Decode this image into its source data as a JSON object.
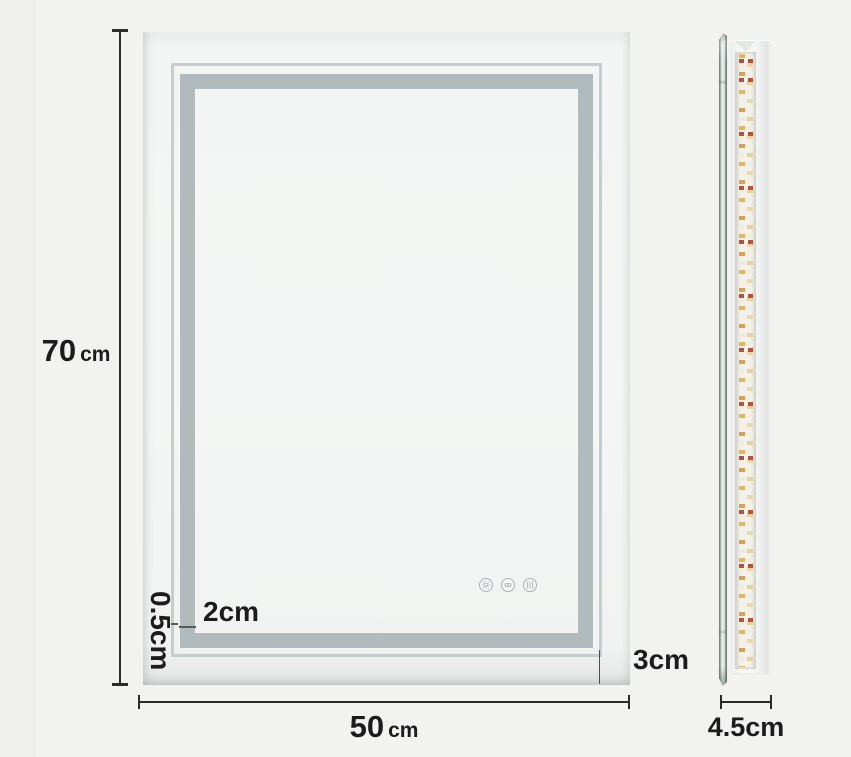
{
  "title": "LED bathroom mirror dimension diagram",
  "front_view": {
    "touch_panel": {
      "buttons": [
        {
          "icon": "brightness-icon"
        },
        {
          "icon": "color-temp-icon"
        },
        {
          "icon": "defog-icon"
        }
      ]
    }
  },
  "side_view": {
    "parts": [
      "mirror-glass-edge",
      "led-strip",
      "back-panel"
    ]
  },
  "dimensions": {
    "height": {
      "value": "70",
      "unit": "cm"
    },
    "width": {
      "value": "50",
      "unit": "cm"
    },
    "depth": {
      "label": "4.5cm"
    },
    "edge_margin": {
      "label": "3cm"
    },
    "band_width": {
      "label": "2cm"
    },
    "line_width": {
      "label": "0.5cm"
    }
  },
  "colors": {
    "background": "#f2f2f1",
    "frosted_band": "#b1bbbd",
    "accent_line": "#c6cdcd",
    "dimension_ink": "#1c1c1c",
    "led_warm": "#e2b65f",
    "led_amber": "#d9a254",
    "led_red": "#b5523c",
    "glass_edge": "#6f7d77"
  }
}
